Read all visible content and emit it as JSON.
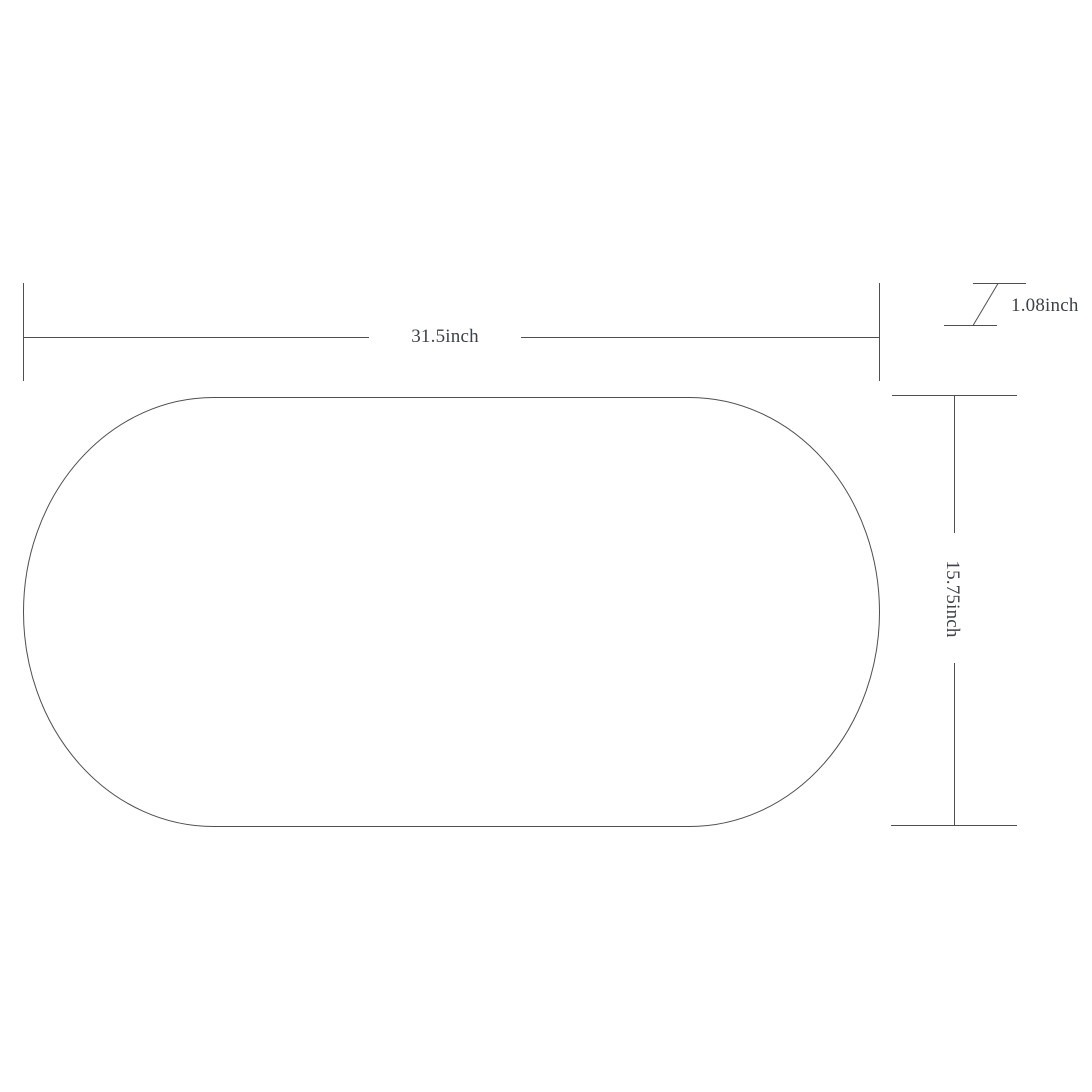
{
  "diagram": {
    "dimensions": {
      "width_label": "31.5inch",
      "height_label": "15.75inch",
      "thickness_label": "1.08inch"
    },
    "colors": {
      "line": "#4f4f4f",
      "text": "#3c4248",
      "background": "#ffffff"
    }
  }
}
